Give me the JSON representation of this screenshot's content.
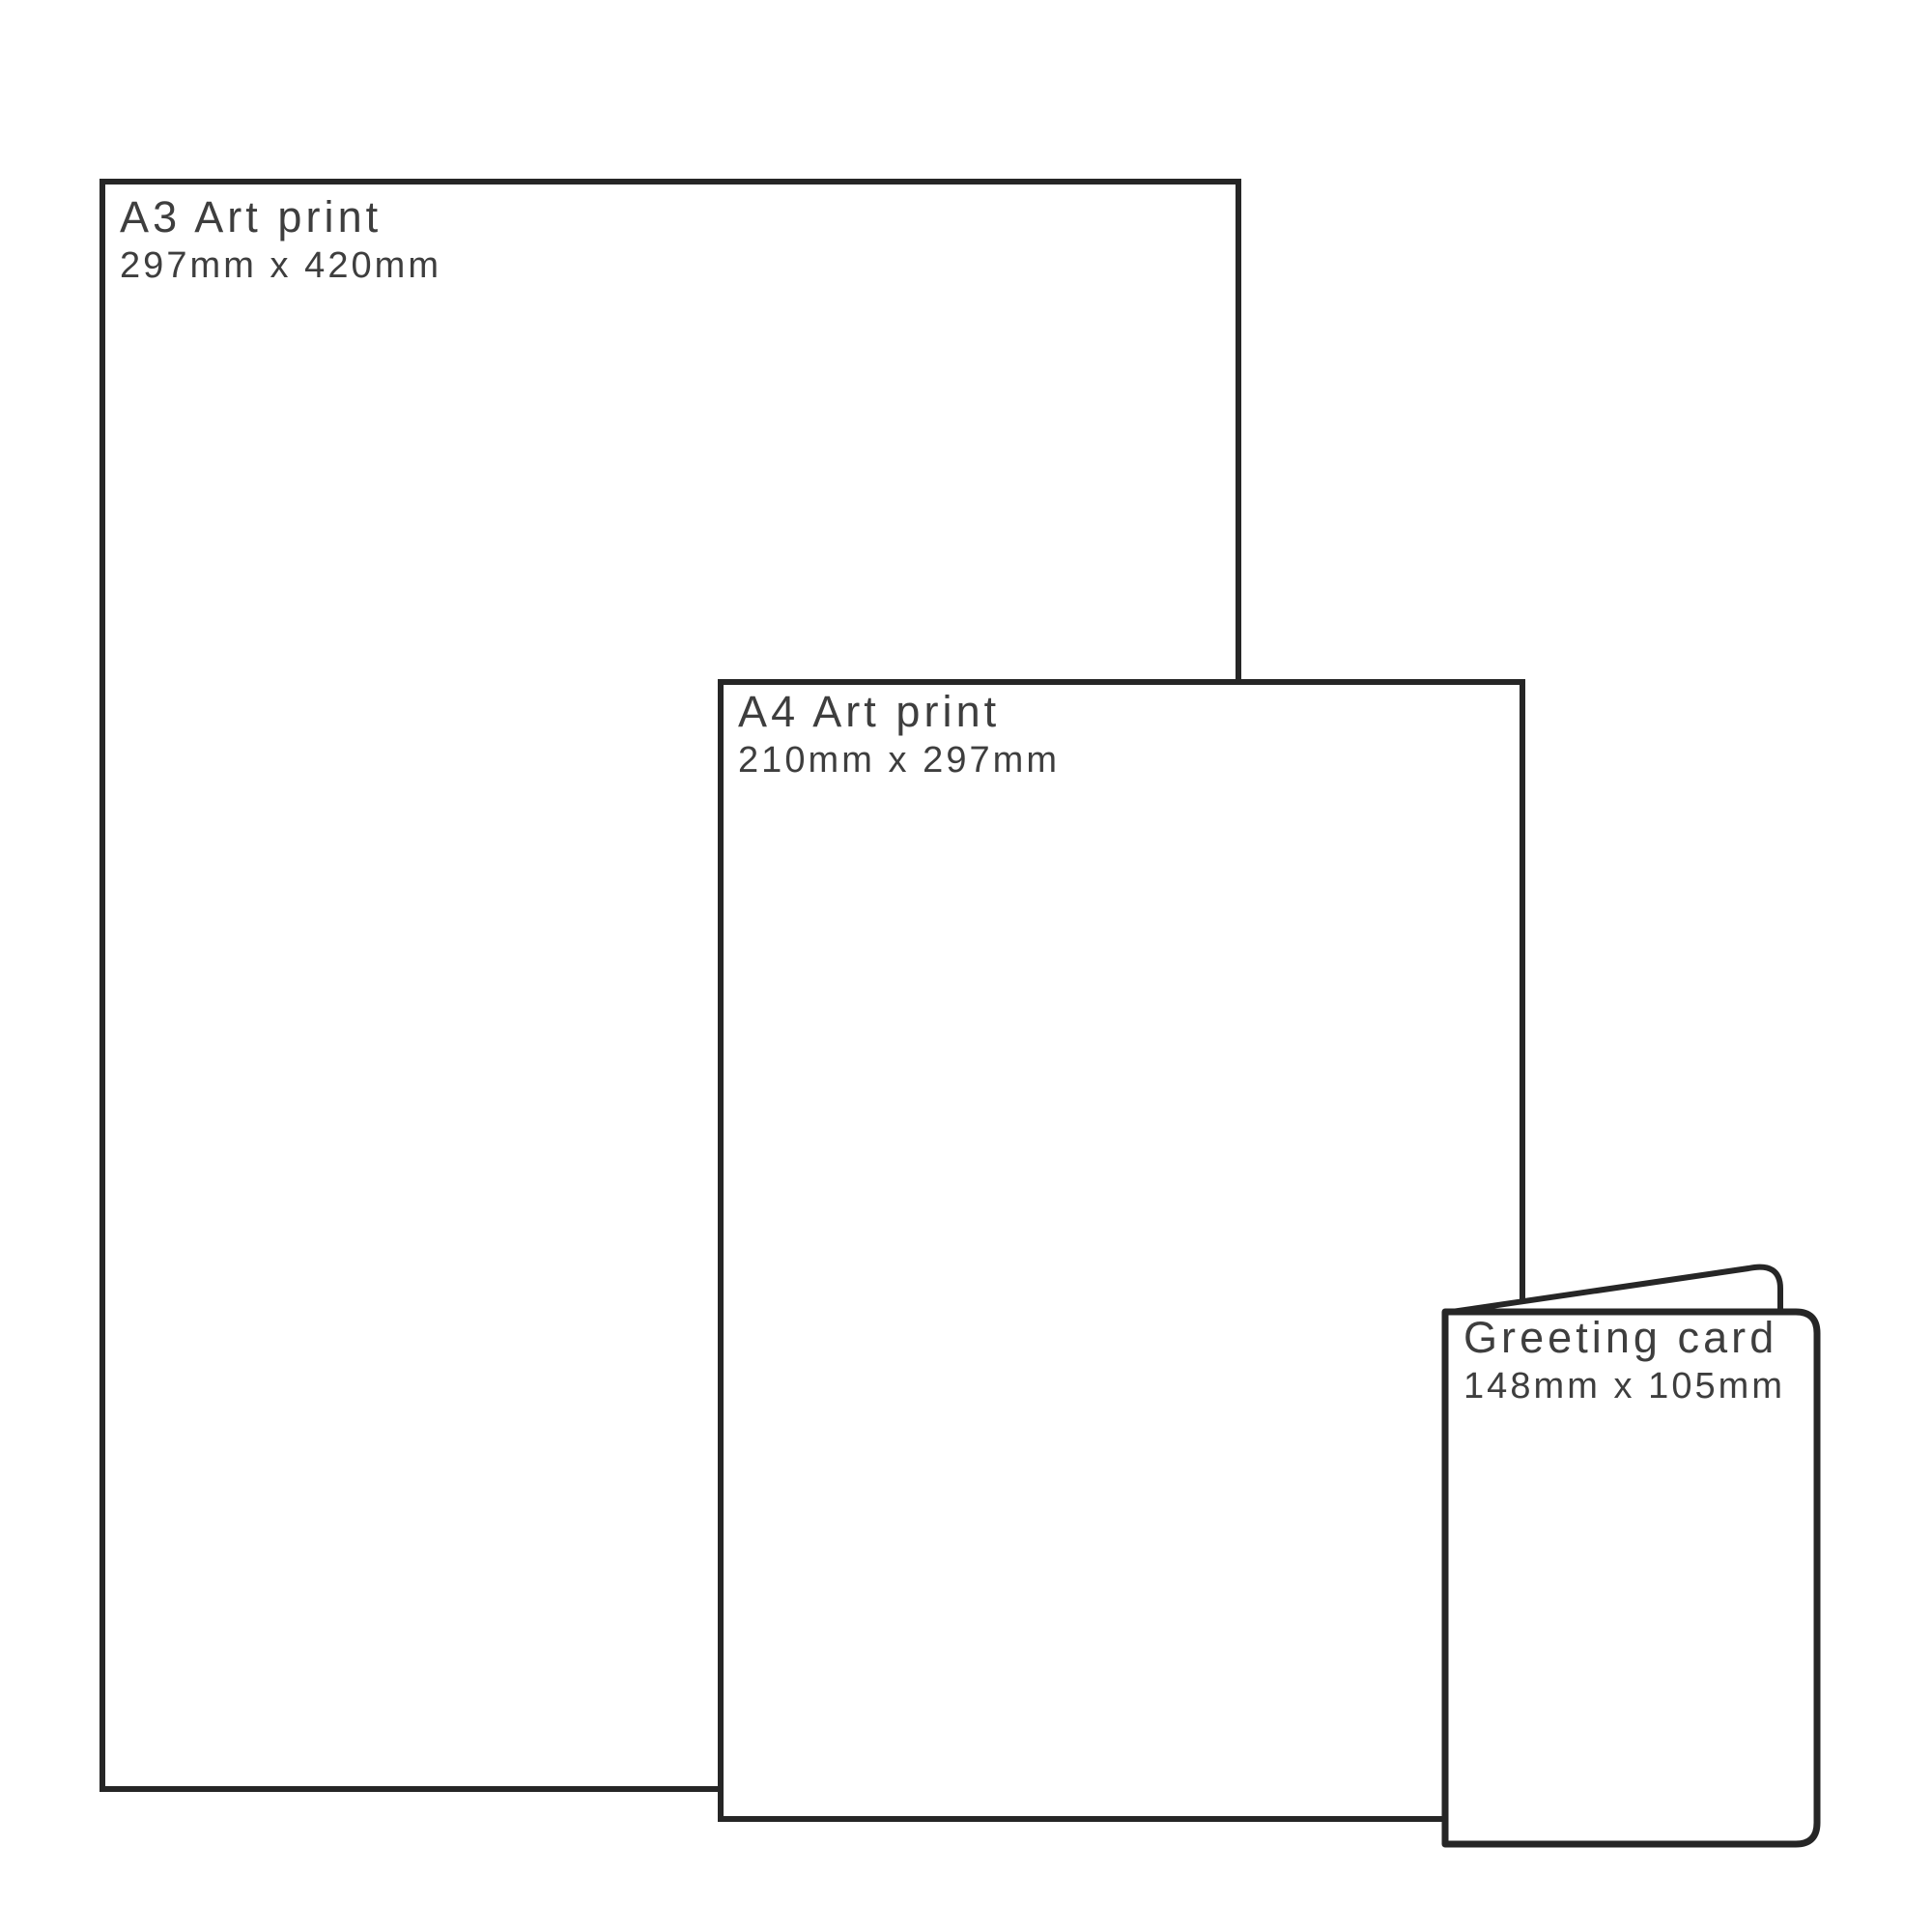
{
  "diagram": {
    "description": "Print product size comparison",
    "colors": {
      "background": "#ffffff",
      "outline": "#262626",
      "text": "#3e3e3e"
    },
    "items": [
      {
        "title": "A3 Art print",
        "dimensions": "297mm x 420mm"
      },
      {
        "title": "A4 Art print",
        "dimensions": "210mm x 297mm"
      },
      {
        "title": "Greeting card",
        "dimensions": "148mm x 105mm"
      }
    ]
  }
}
